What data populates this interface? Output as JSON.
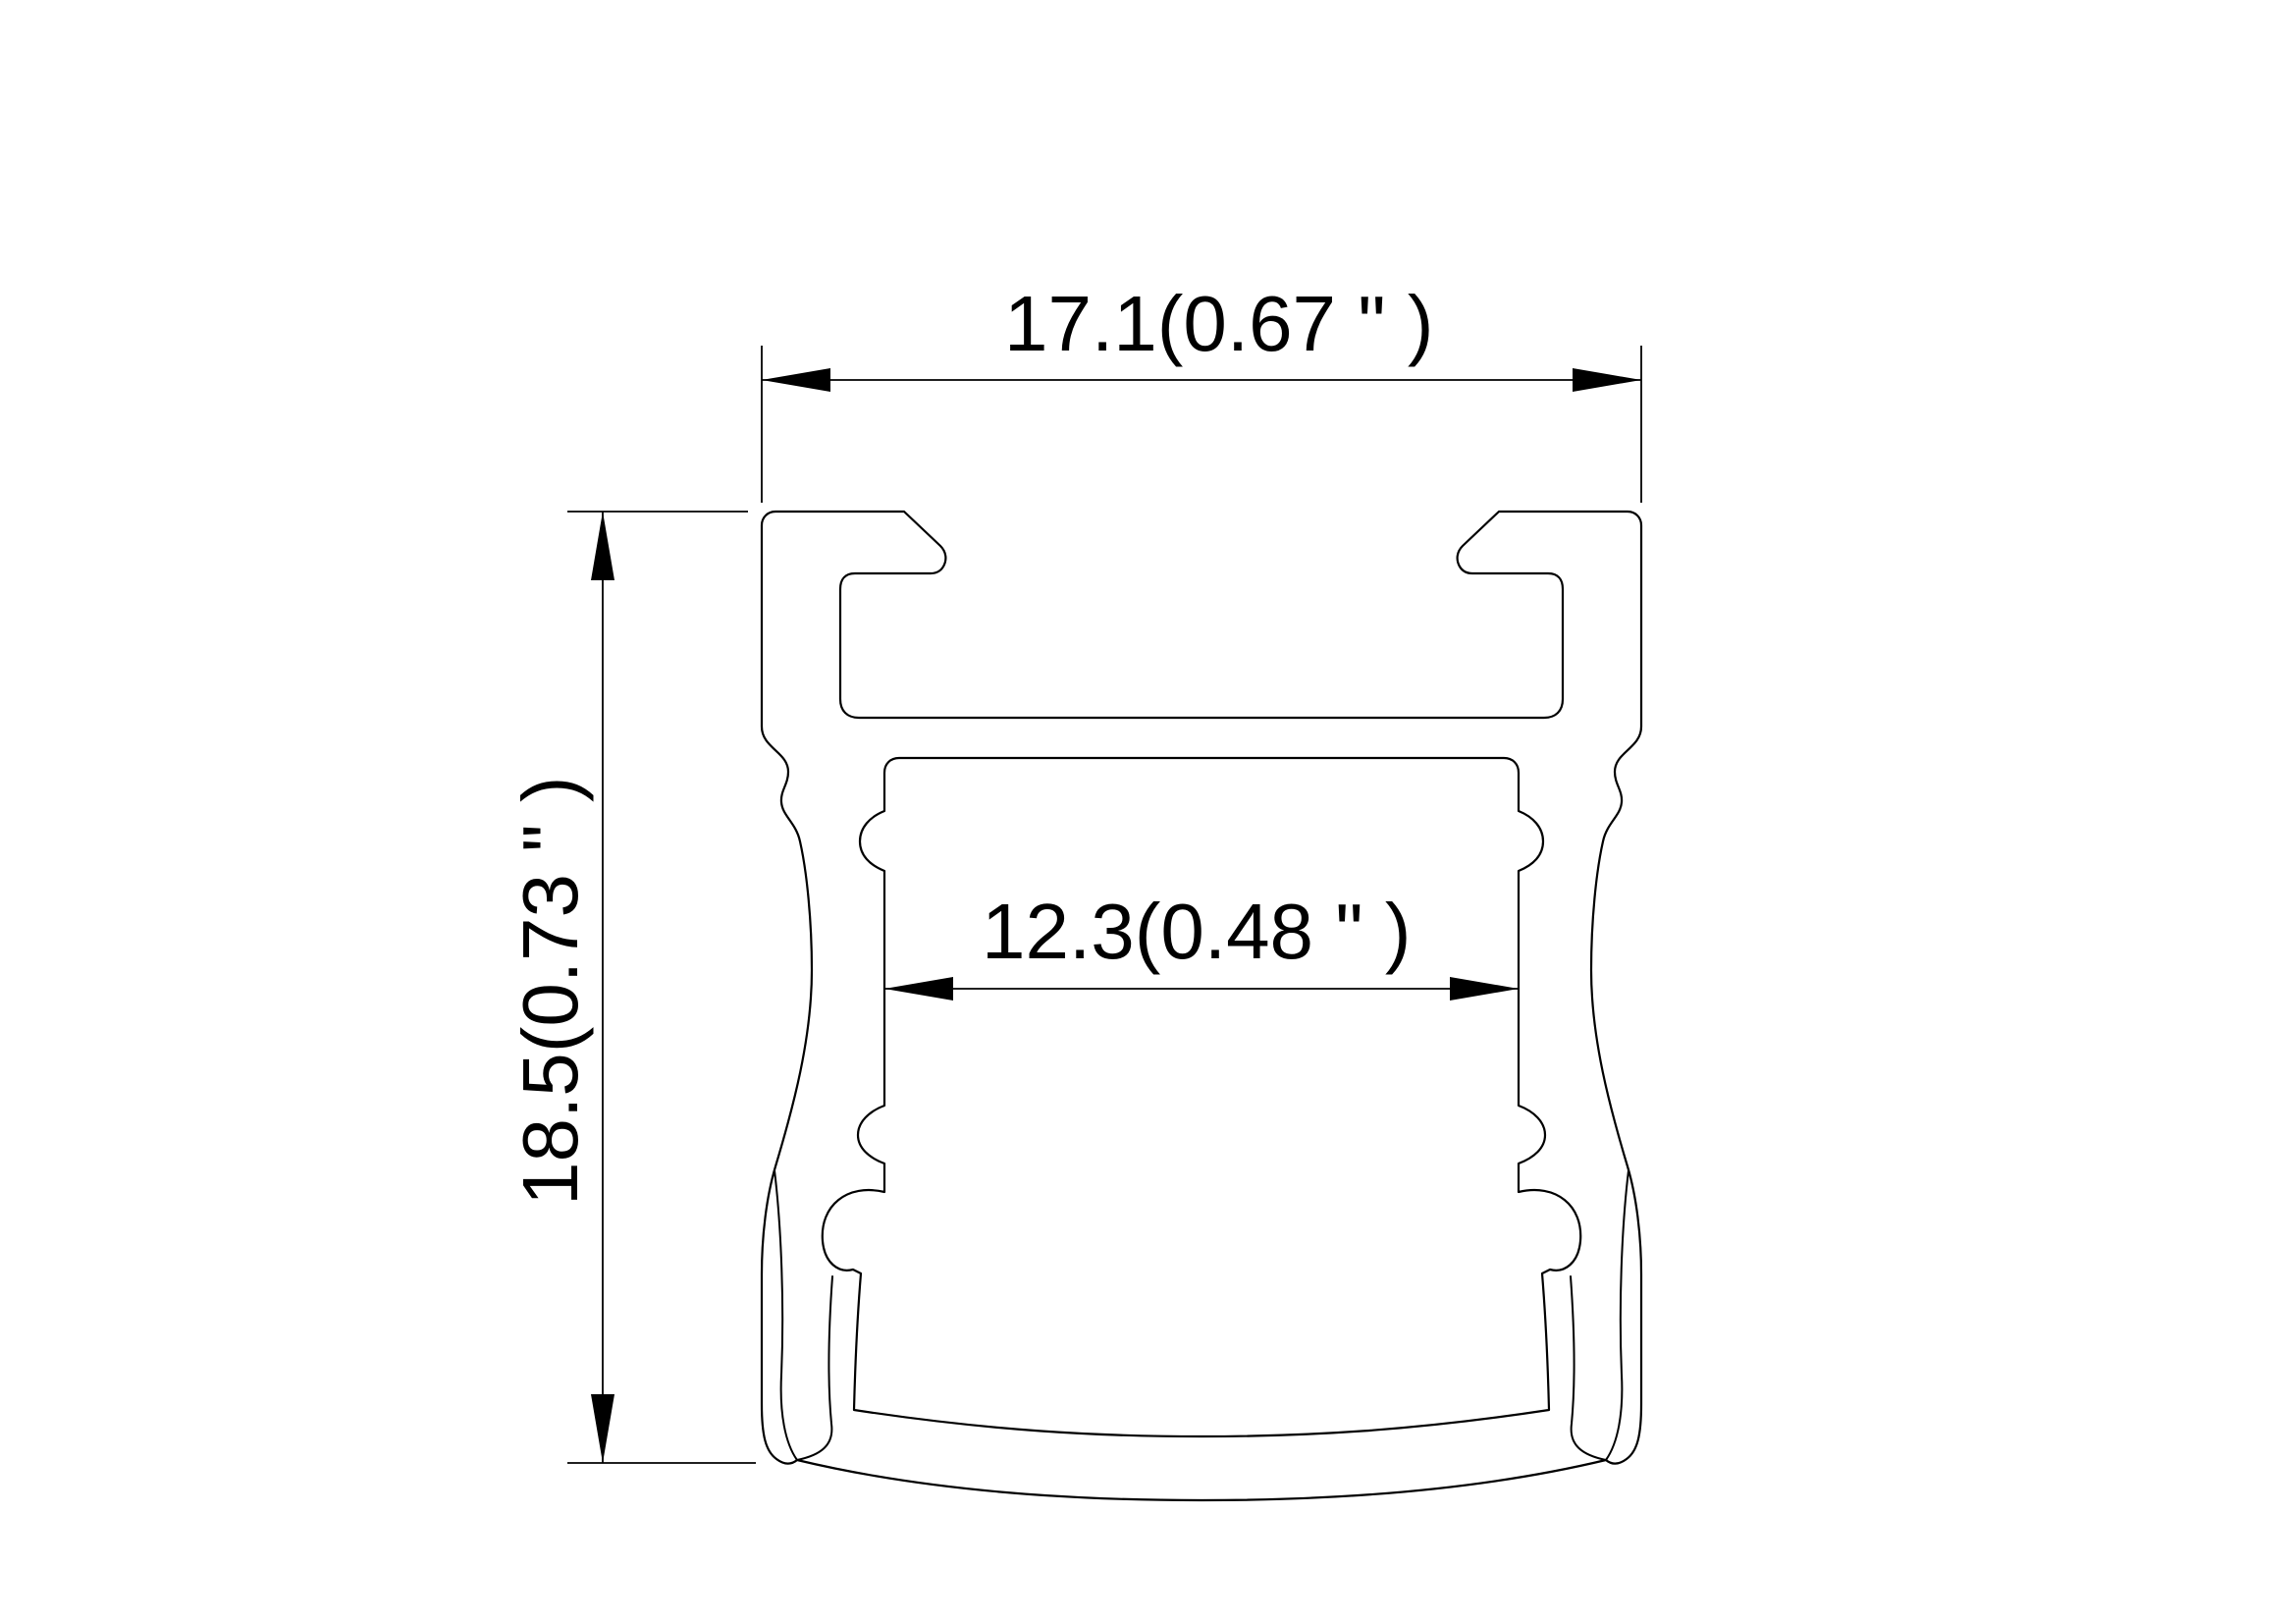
{
  "drawing": {
    "title": "Aluminium LED profile cross-section",
    "type": "technical-dimension-drawing",
    "background_color": "#ffffff",
    "line_color": "#000000",
    "dimensions": {
      "outer_width": {
        "label": "17.1(0.67 \" )",
        "mm": "17.1",
        "inch": "0.67"
      },
      "overall_height": {
        "label": "18.5(0.73 \" )",
        "mm": "18.5",
        "inch": "0.73"
      },
      "inner_width": {
        "label": "12.3(0.48 \" )",
        "mm": "12.3",
        "inch": "0.48"
      }
    }
  }
}
